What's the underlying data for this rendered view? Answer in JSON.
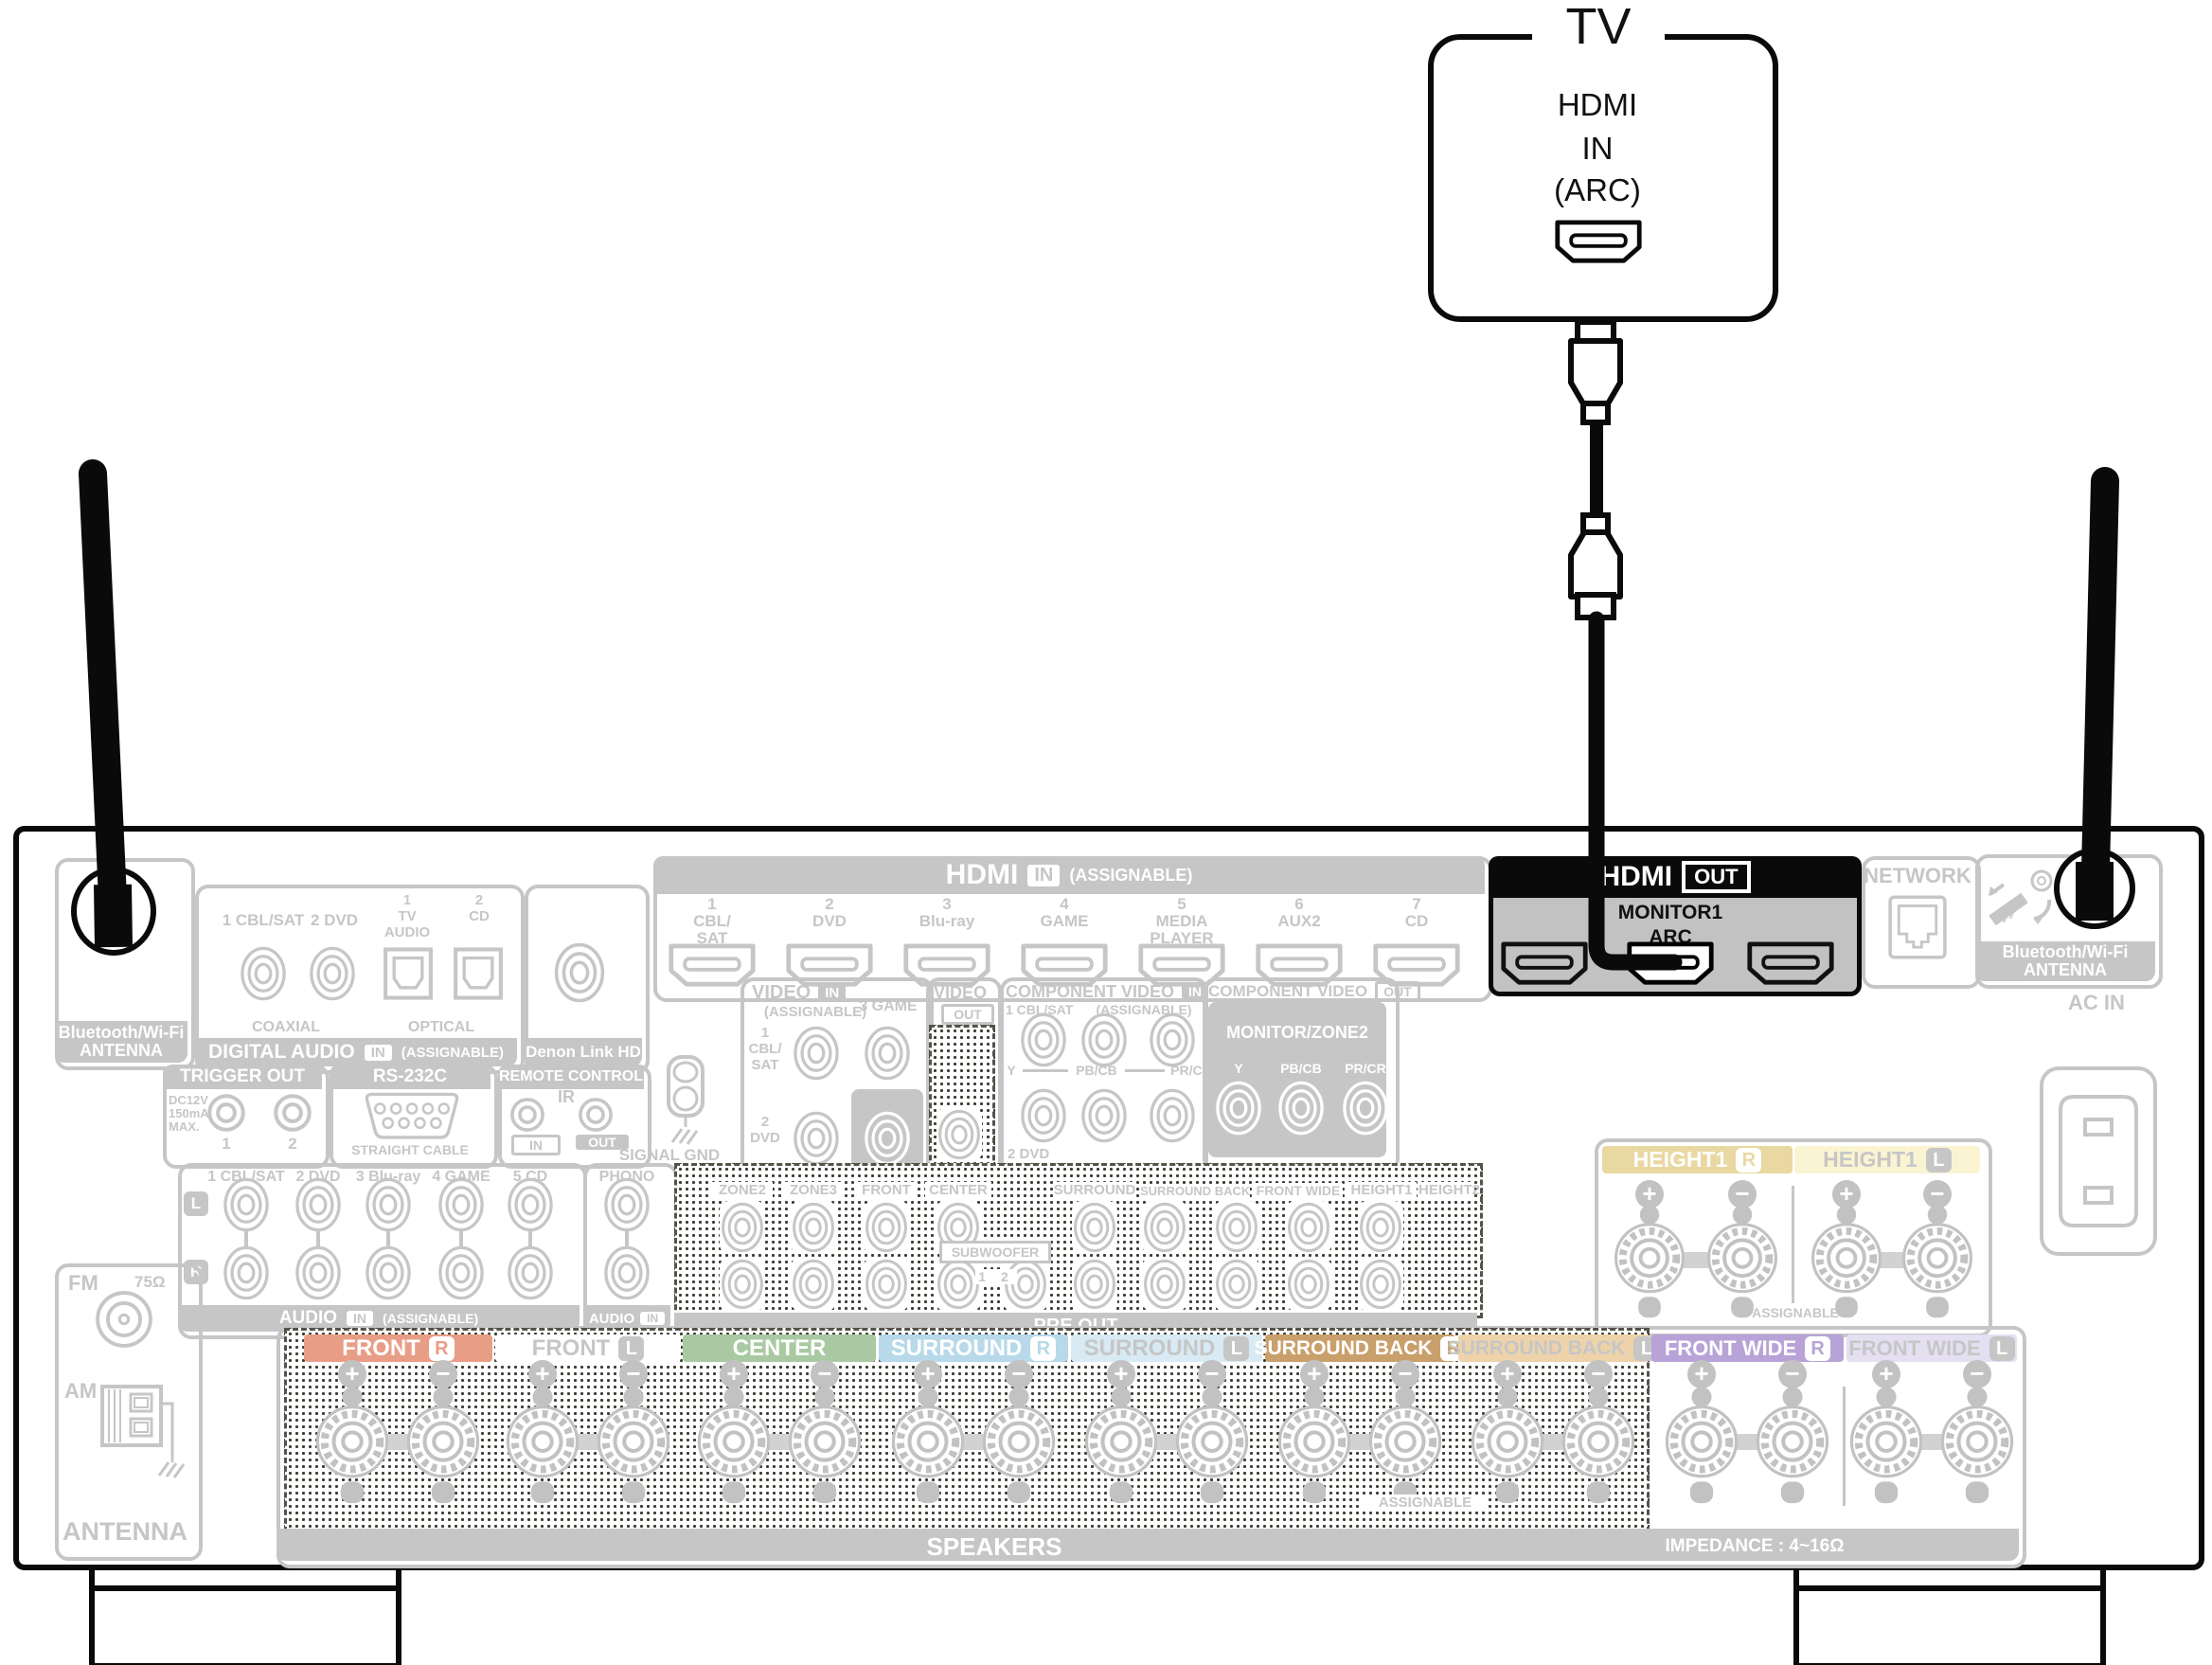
{
  "tv": {
    "title": "TV",
    "port_line1": "HDMI",
    "port_line2": "IN",
    "port_line3": "(ARC)"
  },
  "hdmi_out": {
    "title": "HDMI",
    "badge": "OUT",
    "port_label": "MONITOR1",
    "arc": "ARC"
  },
  "hdmi_in": {
    "title": "HDMI",
    "badge": "IN",
    "assignable": "(ASSIGNABLE)",
    "ports": [
      {
        "num": "1",
        "name1": "CBL/",
        "name2": "SAT"
      },
      {
        "num": "2",
        "name1": "DVD",
        "name2": ""
      },
      {
        "num": "3",
        "name1": "Blu-ray",
        "name2": ""
      },
      {
        "num": "4",
        "name1": "GAME",
        "name2": ""
      },
      {
        "num": "5",
        "name1": "MEDIA",
        "name2": "PLAYER"
      },
      {
        "num": "6",
        "name1": "AUX2",
        "name2": ""
      },
      {
        "num": "7",
        "name1": "CD",
        "name2": ""
      }
    ]
  },
  "network": {
    "title": "NETWORK"
  },
  "bt_antenna": {
    "line1": "Bluetooth/Wi-Fi",
    "line2": "ANTENNA"
  },
  "ac_in": {
    "label": "AC IN"
  },
  "digital_audio": {
    "coax1": "1 CBL/SAT",
    "coax2": "2 DVD",
    "opt1_num": "1",
    "opt1_line1": "TV",
    "opt1_line2": "AUDIO",
    "opt2_num": "2",
    "opt2_name": "CD",
    "coaxial": "COAXIAL",
    "optical": "OPTICAL",
    "footer_name": "DIGITAL AUDIO",
    "footer_badge": "IN",
    "footer_assignable": "(ASSIGNABLE)"
  },
  "denon_link": {
    "label": "Denon Link HD"
  },
  "trigger_out": {
    "title": "TRIGGER OUT",
    "spec1": "DC12V",
    "spec2": "150mA",
    "spec3": "MAX.",
    "jack1": "1",
    "jack2": "2"
  },
  "rs232c": {
    "title": "RS-232C",
    "note": "STRAIGHT CABLE"
  },
  "remote": {
    "title": "REMOTE CONTROL",
    "ir": "IR",
    "in_label": "IN",
    "out_label": "OUT"
  },
  "signal_gnd": {
    "label": "SIGNAL GND"
  },
  "video": {
    "in_name": "VIDEO",
    "in_badge": "IN",
    "assignable": "(ASSIGNABLE)",
    "jack1_num": "1",
    "jack1_line1": "CBL/",
    "jack1_line2": "SAT",
    "jack3": "3 GAME",
    "jack2_num": "2",
    "jack2_name": "DVD",
    "monitor": "MONITOR",
    "out_name": "VIDEO",
    "out_badge": "OUT",
    "zone2": "ZONE2"
  },
  "component_in": {
    "name": "COMPONENT VIDEO",
    "badge": "IN",
    "assignable": "(ASSIGNABLE)",
    "source1": "1 CBL/SAT",
    "y": "Y",
    "pbcb": "PB/CB",
    "prcr": "PR/CR",
    "source2": "2 DVD"
  },
  "component_out": {
    "name": "COMPONENT VIDEO",
    "badge": "OUT",
    "monitor": "MONITOR/ZONE2",
    "y": "Y",
    "pbcb": "PB/CB",
    "prcr": "PR/CR"
  },
  "audio": {
    "headers": [
      "1 CBL/SAT",
      "2 DVD",
      "3 Blu-ray",
      "4 GAME",
      "5 CD"
    ],
    "left": "L",
    "right": "R",
    "footer_name": "AUDIO",
    "footer_badge": "IN",
    "footer_assignable": "(ASSIGNABLE)"
  },
  "phono": {
    "title": "PHONO",
    "footer_name": "AUDIO",
    "footer_badge": "IN"
  },
  "pre_out": {
    "labels": [
      "ZONE2",
      "ZONE3",
      "FRONT",
      "CENTER",
      "SURROUND",
      "SURROUND BACK",
      "FRONT WIDE",
      "HEIGHT1",
      "HEIGHT2"
    ],
    "subwoofer": "SUBWOOFER",
    "subwoofer_nums": "1 2",
    "footer": "PRE OUT"
  },
  "height1": {
    "right_label": "HEIGHT1",
    "right_badge": "R",
    "left_label": "HEIGHT1",
    "left_badge": "L",
    "assignable": "ASSIGNABLE"
  },
  "speakers": {
    "headers": [
      {
        "label": "FRONT",
        "badge": "R"
      },
      {
        "label": "FRONT",
        "badge": "L"
      },
      {
        "label": "CENTER",
        "badge": ""
      },
      {
        "label": "SURROUND",
        "badge": "R"
      },
      {
        "label": "SURROUND",
        "badge": "L"
      },
      {
        "label": "SURROUND BACK",
        "badge": "R"
      },
      {
        "label": "SURROUND BACK",
        "badge": "L"
      },
      {
        "label": "FRONT WIDE",
        "badge": "R"
      },
      {
        "label": "FRONT WIDE",
        "badge": "L"
      }
    ],
    "assignable": "ASSIGNABLE",
    "footer": "SPEAKERS",
    "impedance": "IMPEDANCE : 4~16Ω"
  },
  "fm_am": {
    "fm": "FM",
    "ohm": "75Ω",
    "am": "AM",
    "footer": "ANTENNA"
  },
  "glyphs": {
    "plus": "+",
    "minus": "−"
  },
  "colors": {
    "highlight_black": "#0a0a0a",
    "panel_gray": "#c6c6c6",
    "hdmi_out_body": "#c2c2c2",
    "front_r": "#e89e86",
    "center": "#a9c9a2",
    "surround_r": "#b7d9e9",
    "surround_l": "#d8eaf3",
    "surround_back_r": "#c9a06c",
    "surround_back_l": "#eed3aa",
    "front_wide_r": "#b7a3d7",
    "front_wide_l": "#e5dff2",
    "height1_r": "#e9d8a2",
    "height1_l": "#faf4d2"
  }
}
